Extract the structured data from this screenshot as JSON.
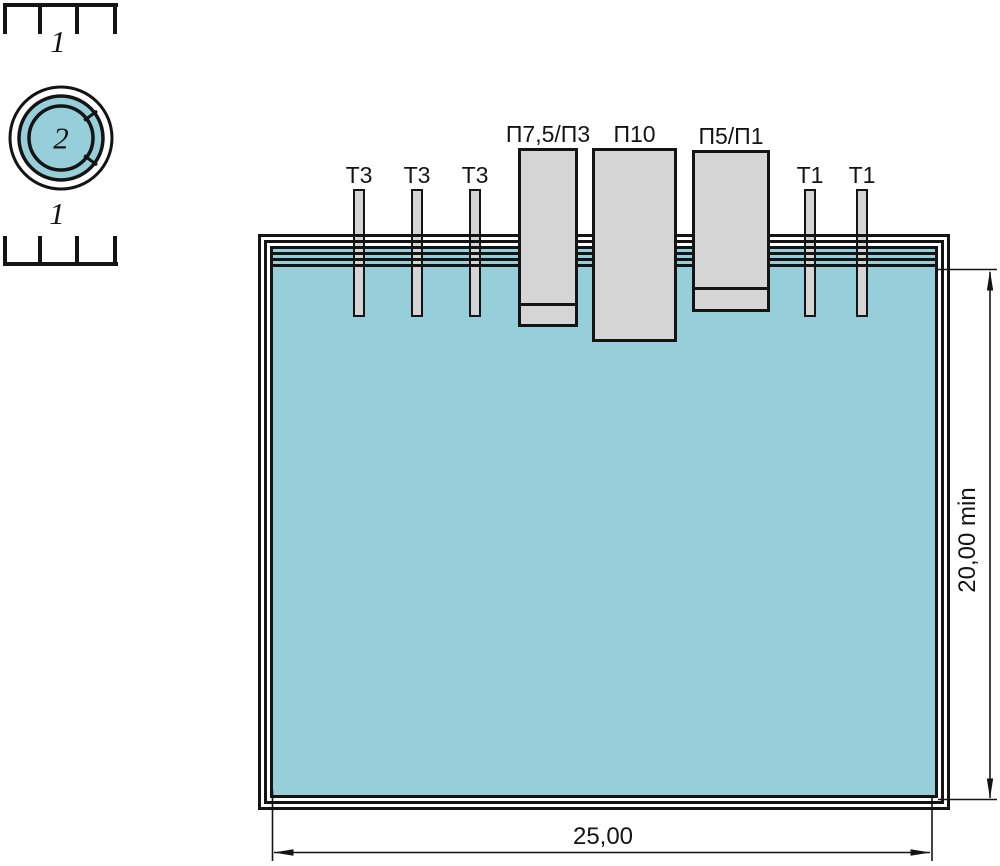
{
  "callouts": {
    "ruler_top": "1",
    "ruler_bottom": "1",
    "circle": "2"
  },
  "probes": {
    "t3_labels": [
      "Т3",
      "Т3",
      "Т3"
    ],
    "wide_labels": [
      "П7,5/П3",
      "П10",
      "П5/П1"
    ],
    "t1_labels": [
      "Т1",
      "Т1"
    ]
  },
  "dimensions": {
    "width": "25,00",
    "depth": "20,00 min"
  },
  "colors": {
    "liquid": "#96cfd9",
    "rod_fill": "#d5d5d5",
    "line": "#141414"
  }
}
